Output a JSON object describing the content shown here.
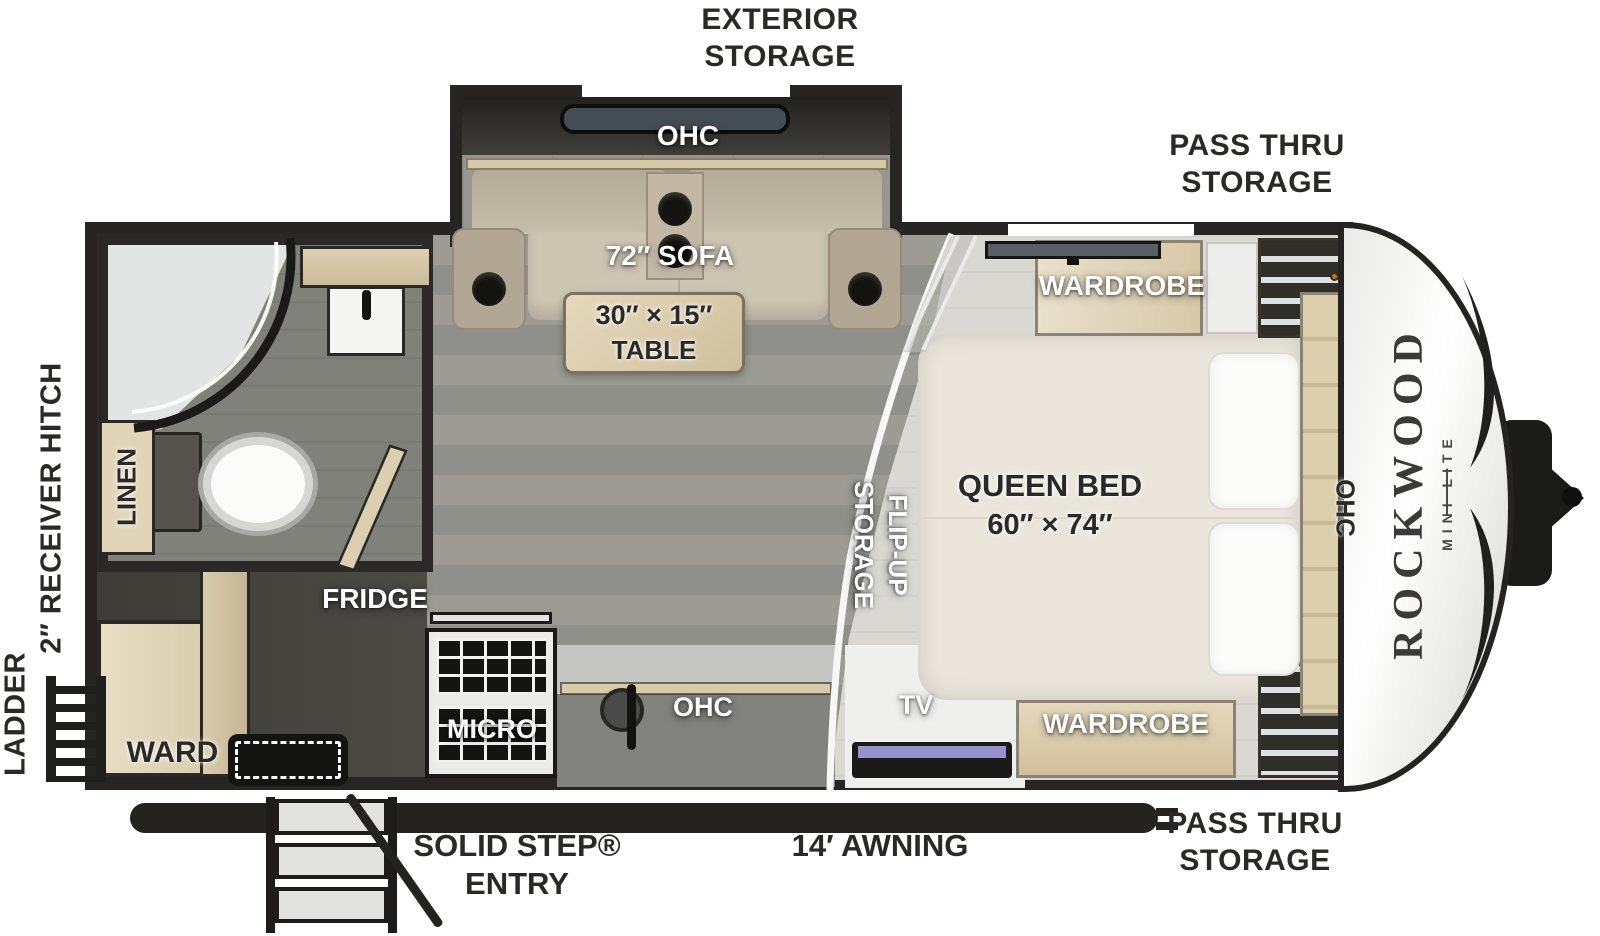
{
  "title": "Rockwood Mini Lite travel trailer floor plan",
  "brand": {
    "name": "ROCKWOOD",
    "sub": "MINI LITE"
  },
  "exterior": {
    "exterior_storage": "EXTERIOR STORAGE",
    "pass_thru_storage_top": "PASS THRU STORAGE",
    "pass_thru_storage_bottom": "PASS THRU STORAGE",
    "awning": "14′ AWNING",
    "solid_step_entry": "SOLID STEP® ENTRY",
    "receiver_hitch": "2″ RECEIVER HITCH",
    "ladder": "LADDER"
  },
  "interior": {
    "slide_ohc": "OHC",
    "sofa": "72″ SOFA",
    "table_line1": "30″ × 15″",
    "table_line2": "TABLE",
    "wardrobe_front": "WARDROBE",
    "wardrobe_rear": "WARDROBE",
    "queen_bed_line1": "QUEEN BED",
    "queen_bed_line2": "60″ × 74″",
    "bed_ohc": "OHC",
    "flip_up_line1": "FLIP-UP",
    "flip_up_line2": "STORAGE",
    "linen": "LINEN",
    "fridge": "FRIDGE",
    "micro": "MICRO",
    "kitchen_ohc": "OHC",
    "tv": "TV",
    "ward": "WARD"
  },
  "palette": {
    "wall": "#262523",
    "living_floor": "#97978f",
    "bedroom_floor": "#d9d8d3",
    "wood_cabinet": "#d9cdb0",
    "label_dark": "#2b2927",
    "label_light": "#ffffff",
    "tv_screen": "#9a92cf",
    "front_cap": "#f4f4f2",
    "divider_line": "#f7f7f5"
  }
}
